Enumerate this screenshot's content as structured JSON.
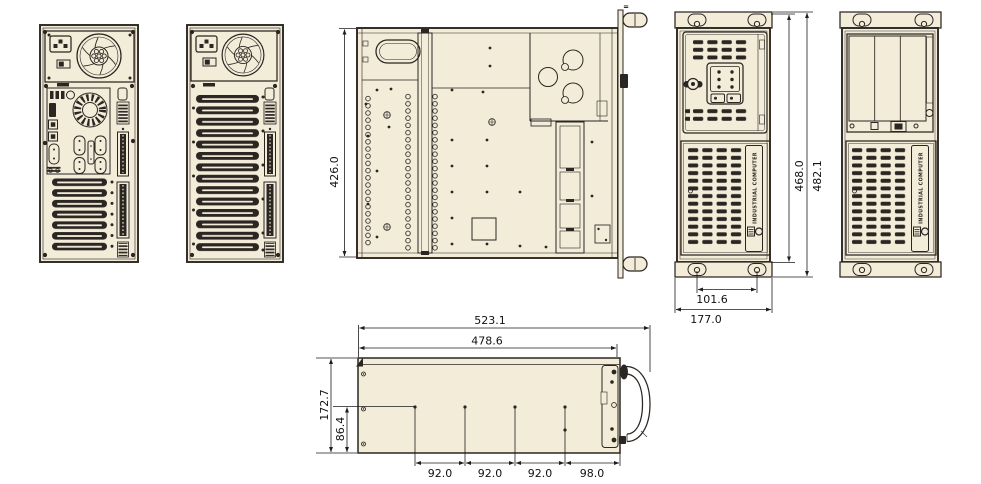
{
  "document_type": "industrial-computer-chassis-technical-drawing",
  "colors": {
    "background": "#ffffff",
    "panel_fill": "#f2ecd9",
    "line": "#2b2622",
    "dark_fill": "#2b2622"
  },
  "dimensions": {
    "top_view_depth": "426.0",
    "front_inner_height": "468.0",
    "front_outer_height": "482.1",
    "handle_hole_spacing": "101.6",
    "front_width": "177.0",
    "side_outer_length": "523.1",
    "side_inner_length": "478.6",
    "side_outer_height": "172.7",
    "side_inner_height": "86.4",
    "mount_hole_spacings": [
      "92.0",
      "92.0",
      "92.0",
      "98.0"
    ]
  },
  "branding": {
    "strip_text": "INDUSTRIAL COMPUTER"
  },
  "marks": {
    "top_mark": "="
  }
}
